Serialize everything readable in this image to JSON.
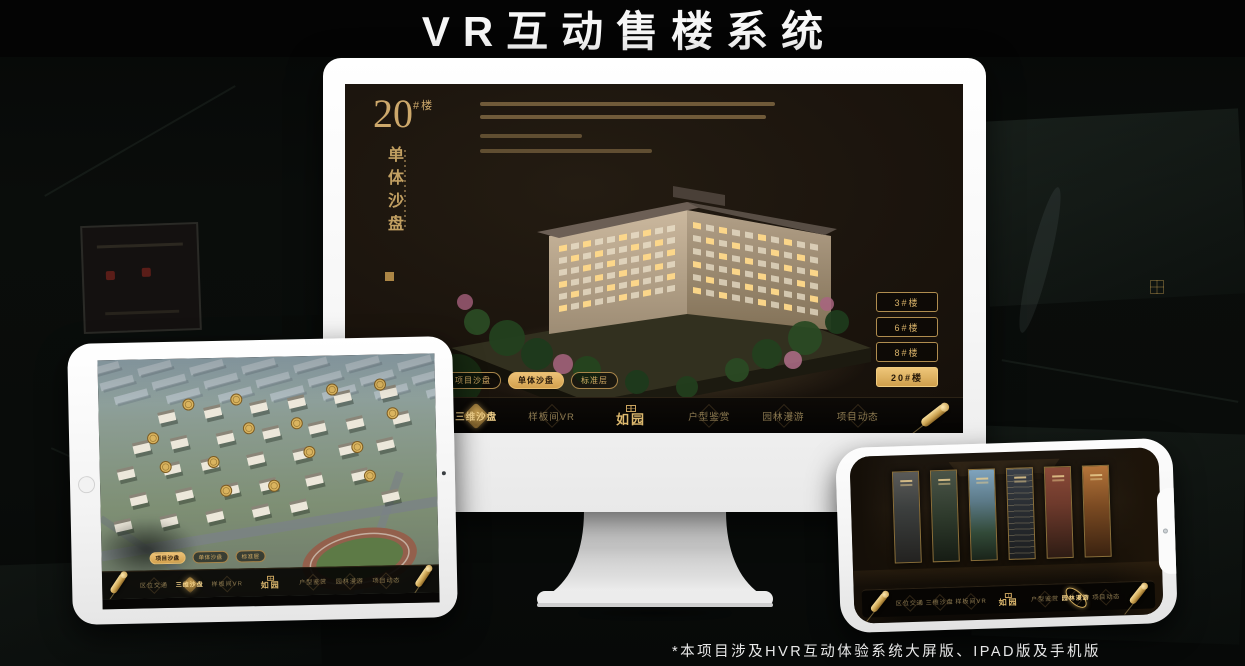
{
  "page": {
    "title": "VR互动售楼系统",
    "footnote": "*本项目涉及HVR互动体验系统大屏版、IPAD版及手机版"
  },
  "monitor": {
    "heading": {
      "number": "20",
      "suffix": "#楼",
      "vertical_title": "单体沙盘"
    },
    "building_buttons": [
      {
        "label": "3#楼"
      },
      {
        "label": "6#楼"
      },
      {
        "label": "8#楼"
      },
      {
        "label": "20#楼",
        "active": true
      }
    ],
    "tabs": [
      {
        "label": "项目沙盘"
      },
      {
        "label": "单体沙盘",
        "active": true
      },
      {
        "label": "标准层"
      }
    ],
    "nav_left": [
      {
        "label": "区位交通"
      },
      {
        "label": "三维沙盘",
        "active": true
      },
      {
        "label": "样板间VR"
      }
    ],
    "nav_right": [
      {
        "label": "户型鉴赏"
      },
      {
        "label": "园林漫游"
      },
      {
        "label": "项目动态"
      }
    ],
    "logo": "如园"
  },
  "ipad": {
    "tabs": [
      {
        "label": "项目沙盘",
        "active": true
      },
      {
        "label": "单体沙盘"
      },
      {
        "label": "标准层"
      }
    ],
    "nav_left": [
      {
        "label": "区位交通"
      },
      {
        "label": "三维沙盘",
        "active": true
      },
      {
        "label": "样板间VR"
      }
    ],
    "nav_right": [
      {
        "label": "户型鉴赏"
      },
      {
        "label": "园林漫游"
      },
      {
        "label": "项目动态"
      }
    ],
    "logo": "如园"
  },
  "phone": {
    "nav_left": [
      {
        "label": "区位交通"
      },
      {
        "label": "三维沙盘"
      },
      {
        "label": "样板间VR"
      }
    ],
    "nav_right": [
      {
        "label": "户型鉴赏"
      },
      {
        "label": "园林漫游",
        "active": true
      },
      {
        "label": "项目动态"
      }
    ],
    "logo": "如园"
  },
  "colors": {
    "gold": "#d8b269",
    "gold_bright": "#eec679",
    "screen_bg": "#17120c",
    "accent_text": "#cda86b"
  }
}
